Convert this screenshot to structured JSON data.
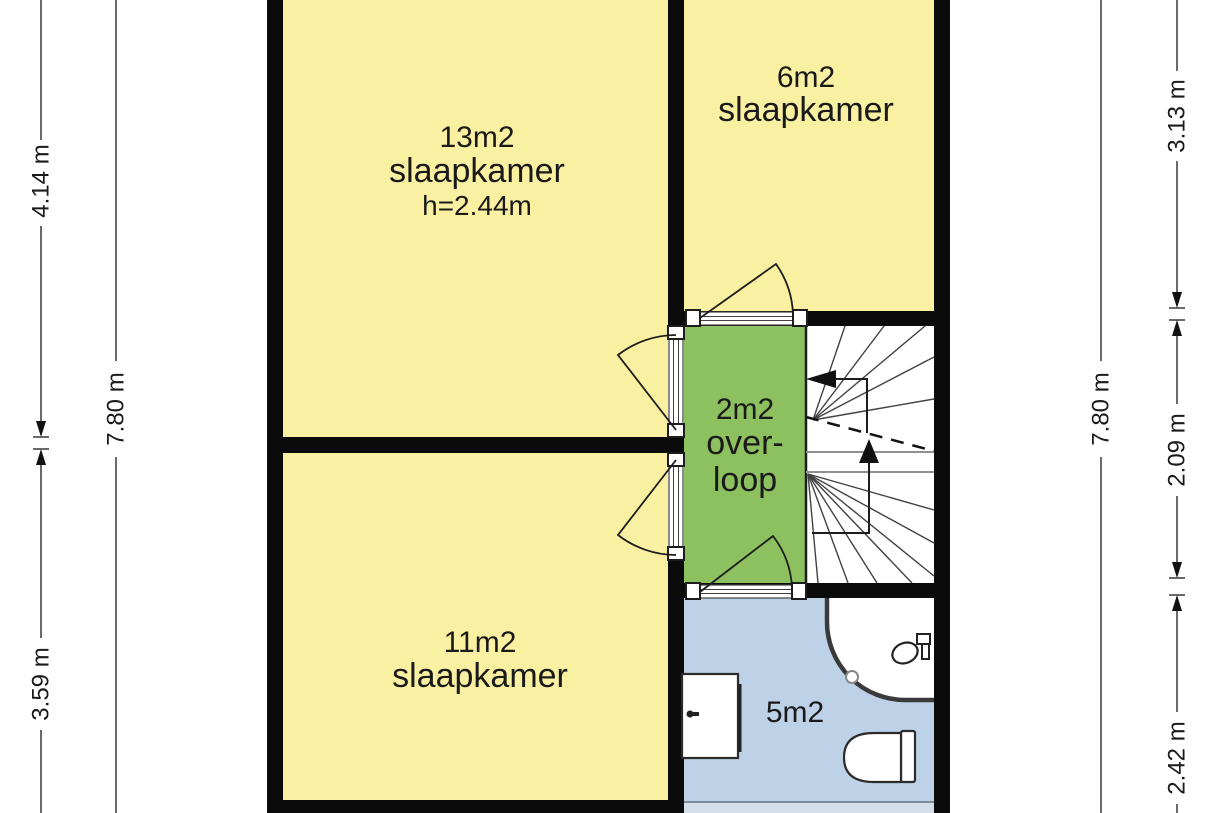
{
  "rooms": {
    "bedroom_13": {
      "area": "13m2",
      "name": "slaapkamer",
      "ceiling_height": "h=2.44m"
    },
    "bedroom_6": {
      "area": "6m2",
      "name": "slaapkamer"
    },
    "landing": {
      "area": "2m2",
      "name_line1": "over-",
      "name_line2": "loop"
    },
    "bedroom_11": {
      "area": "11m2",
      "name": "slaapkamer"
    },
    "bathroom": {
      "area": "5m2"
    }
  },
  "dimensions": {
    "left_top": "4.14 m",
    "left_bottom": "3.59 m",
    "left_total": "7.80 m",
    "right_total": "7.80 m",
    "right_top": "3.13 m",
    "right_middle": "2.09 m",
    "right_bottom": "2.42 m"
  },
  "colors": {
    "bedroom_fill": "#FAF0A2",
    "landing_fill": "#8DC05F",
    "bathroom_fill": "#BDD2E7",
    "window_strip": "#D5DFEB",
    "wall": "#0B0B0B",
    "text": "#1A1A1A"
  },
  "icons": {
    "stairs": "winder-staircase-icon",
    "up_arrow": "stair-direction-up-icon",
    "exit_arrow": "stair-direction-left-icon",
    "shower": "corner-shower-icon",
    "shower_tap": "shower-tap-icon",
    "drain": "shower-drain-icon",
    "toilet": "toilet-icon",
    "cabinet": "cabinet-icon",
    "door": "door-swing-arc-icon"
  }
}
